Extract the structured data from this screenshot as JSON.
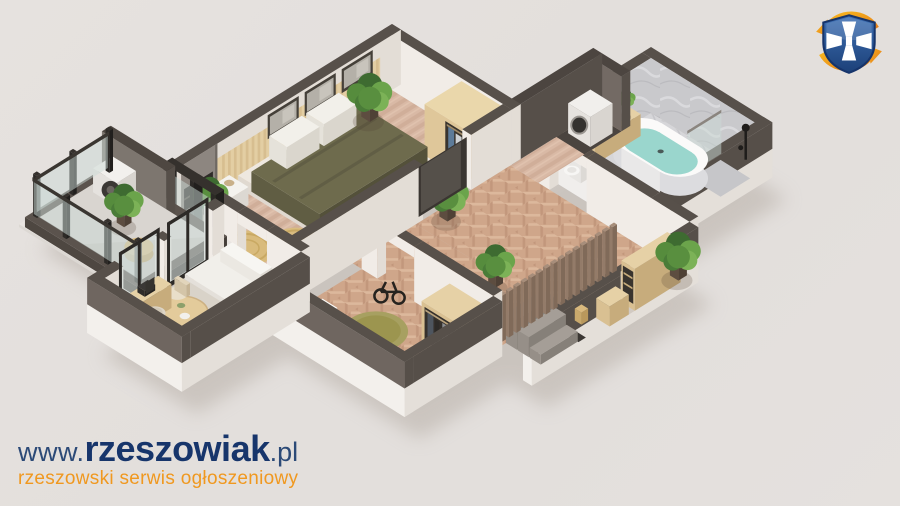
{
  "branding": {
    "url_www": "www.",
    "url_name": "rzeszowiak",
    "url_tld": ".pl",
    "tagline": "rzeszowski serwis ogłoszeniowy"
  },
  "logo_icon": "shield-cross-swoosh-icon",
  "render": {
    "kind": "isometric 3D apartment floor plan"
  },
  "palette": {
    "background": "#e3dfdc",
    "brand_navy": "#17356b",
    "brand_navy_light": "#2c4a77",
    "brand_orange": "#f0981f",
    "wall_top_dark": "#57504a",
    "interior_white": "#f1ece7",
    "floor_herringbone": "#cfa68a",
    "floor_bedroom": "#d9b9a5",
    "marble_gray": "#d6d6d9",
    "duvet_olive": "#6e6b4d",
    "water_teal": "#9ad6cd",
    "jute": "#d9bc80",
    "wood_light": "#e6d1a6",
    "charcoal_frame": "#2d2a27",
    "plant_green": "#568c3d",
    "rug_olive": "#a7a061"
  }
}
